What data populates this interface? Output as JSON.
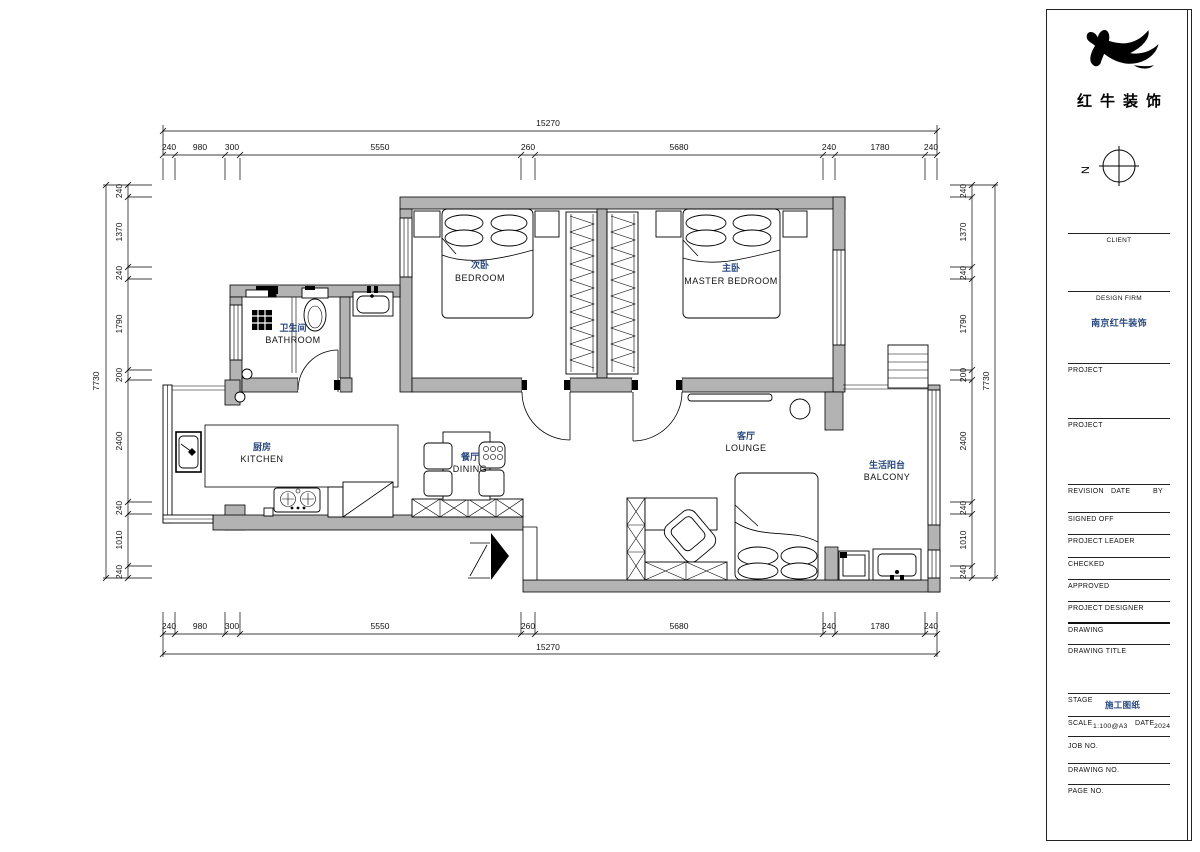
{
  "plan": {
    "rooms": {
      "bedroom2": {
        "zh": "次卧",
        "en": "BEDROOM"
      },
      "master": {
        "zh": "主卧",
        "en": "MASTER BEDROOM"
      },
      "bathroom": {
        "zh": "卫生间",
        "en": "BATHROOM"
      },
      "kitchen": {
        "zh": "厨房",
        "en": "KITCHEN"
      },
      "dining": {
        "zh": "餐厅",
        "en": "DINING"
      },
      "lounge": {
        "zh": "客厅",
        "en": "LOUNGE"
      },
      "balcony": {
        "zh": "生活阳台",
        "en": "BALCONY"
      }
    },
    "colors": {
      "wall": "#b3b3b3",
      "label_zh": "#2b4a80",
      "line": "#000000"
    }
  },
  "dims": {
    "top": {
      "total": "15270",
      "segments": [
        "240",
        "980",
        "300",
        "5550",
        "260",
        "5680",
        "240",
        "1780",
        "240"
      ]
    },
    "bottom": {
      "total": "15270",
      "segments": [
        "240",
        "980",
        "300",
        "5550",
        "260",
        "5680",
        "240",
        "1780",
        "240"
      ]
    },
    "left": {
      "total": "7730",
      "segments": [
        "240",
        "1370",
        "240",
        "1790",
        "200",
        "2400",
        "240",
        "1010",
        "240"
      ]
    },
    "right": {
      "total": "7730",
      "segments": [
        "240",
        "1370",
        "240",
        "1790",
        "200",
        "2400",
        "240",
        "1010",
        "240"
      ]
    }
  },
  "title_block": {
    "logo_text": "红牛装饰",
    "north_label": "N",
    "client_label": "CLIENT",
    "design_firm_label": "DESIGN FIRM",
    "design_firm_value": "南京红牛装饰",
    "project1_label": "PROJECT",
    "project2_label": "PROJECT",
    "revision_label": "REVISION",
    "date_label": "DATE",
    "by_label": "BY",
    "signed_off_label": "SIGNED OFF",
    "project_leader_label": "PROJECT LEADER",
    "checked_label": "CHECKED",
    "approved_label": "APPROVED",
    "project_designer_label": "PROJECT DESIGNER",
    "drawing_label": "DRAWING",
    "drawing_title_label": "DRAWING TITLE",
    "stage_label": "STAGE",
    "stage_value": "施工图纸",
    "scale_label": "SCALE",
    "scale_value": "1:100@A3",
    "date2_label": "DATE",
    "date_value": "2024",
    "job_no_label": "JOB NO.",
    "drawing_no_label": "DRAWING NO.",
    "page_no_label": "PAGE NO."
  }
}
